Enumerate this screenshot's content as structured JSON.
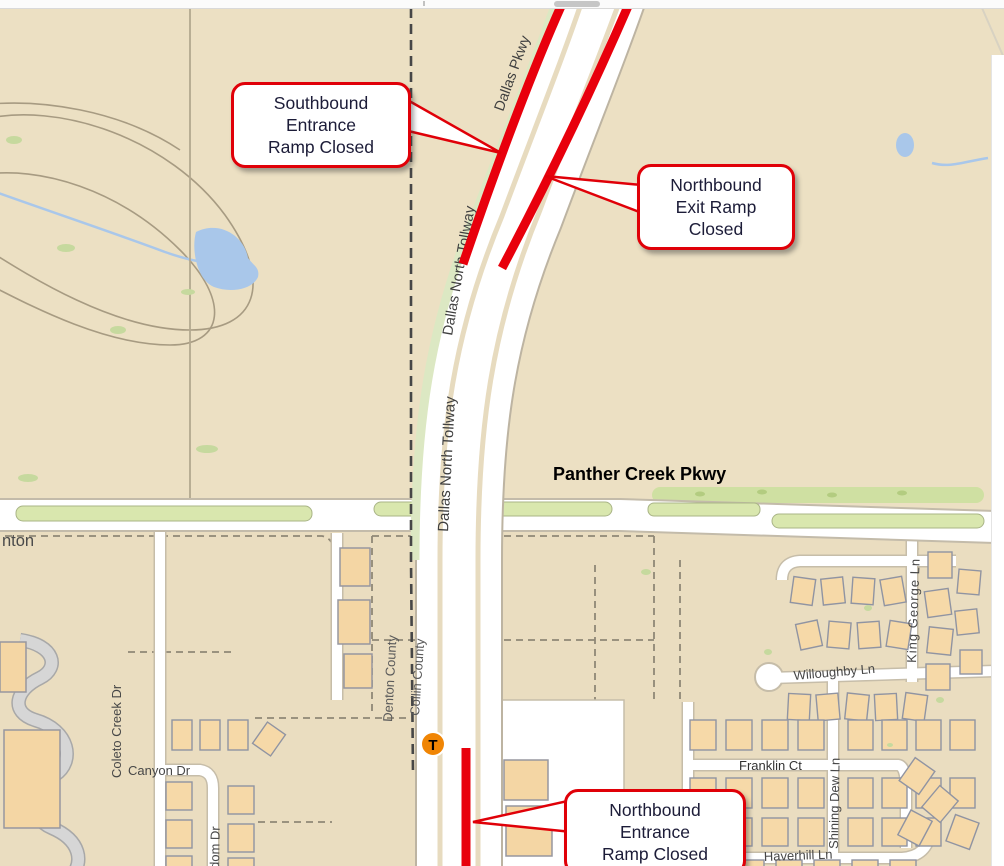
{
  "callouts": {
    "southbound_entrance": {
      "lines": [
        "Southbound",
        "Entrance",
        "Ramp Closed"
      ]
    },
    "northbound_exit": {
      "lines": [
        "Northbound",
        "Exit Ramp",
        "Closed"
      ]
    },
    "northbound_entrance": {
      "lines": [
        "Northbound",
        "Entrance",
        "Ramp Closed"
      ]
    }
  },
  "map_labels": {
    "panther_creek_pkwy": "Panther Creek Pkwy",
    "dallas_pkwy": "Dallas Pkwy",
    "dallas_north_tollway": "Dallas North Tollway",
    "dallas_north_tollway_upper": "Dallas North Tollway",
    "denton_county": "Denton County",
    "collin_county": "Collin County",
    "denton_partial": "nton",
    "coleto_creek_dr": "Coleto Creek Dr",
    "canyon_dr": "Canyon Dr",
    "dom_dr_partial": "dom Dr",
    "willoughby_ln": "Willoughby Ln",
    "king_george_ln": "King George Ln",
    "franklin_ct": "Franklin Ct",
    "shining_dew_ln": "Shining Dew Ln",
    "haverhill_ln": "Haverhill Ln"
  },
  "markers": {
    "toll_transponder": {
      "letter": "T",
      "background": "#f08504"
    }
  },
  "colors": {
    "closure_red": "#e8000c",
    "callout_border": "#e00008",
    "map_background": "#ece0c3",
    "road_white": "#ffffff",
    "median_green": "#d9e7ae",
    "water_blue": "#a9c7ea",
    "label_gray": "#474747"
  }
}
